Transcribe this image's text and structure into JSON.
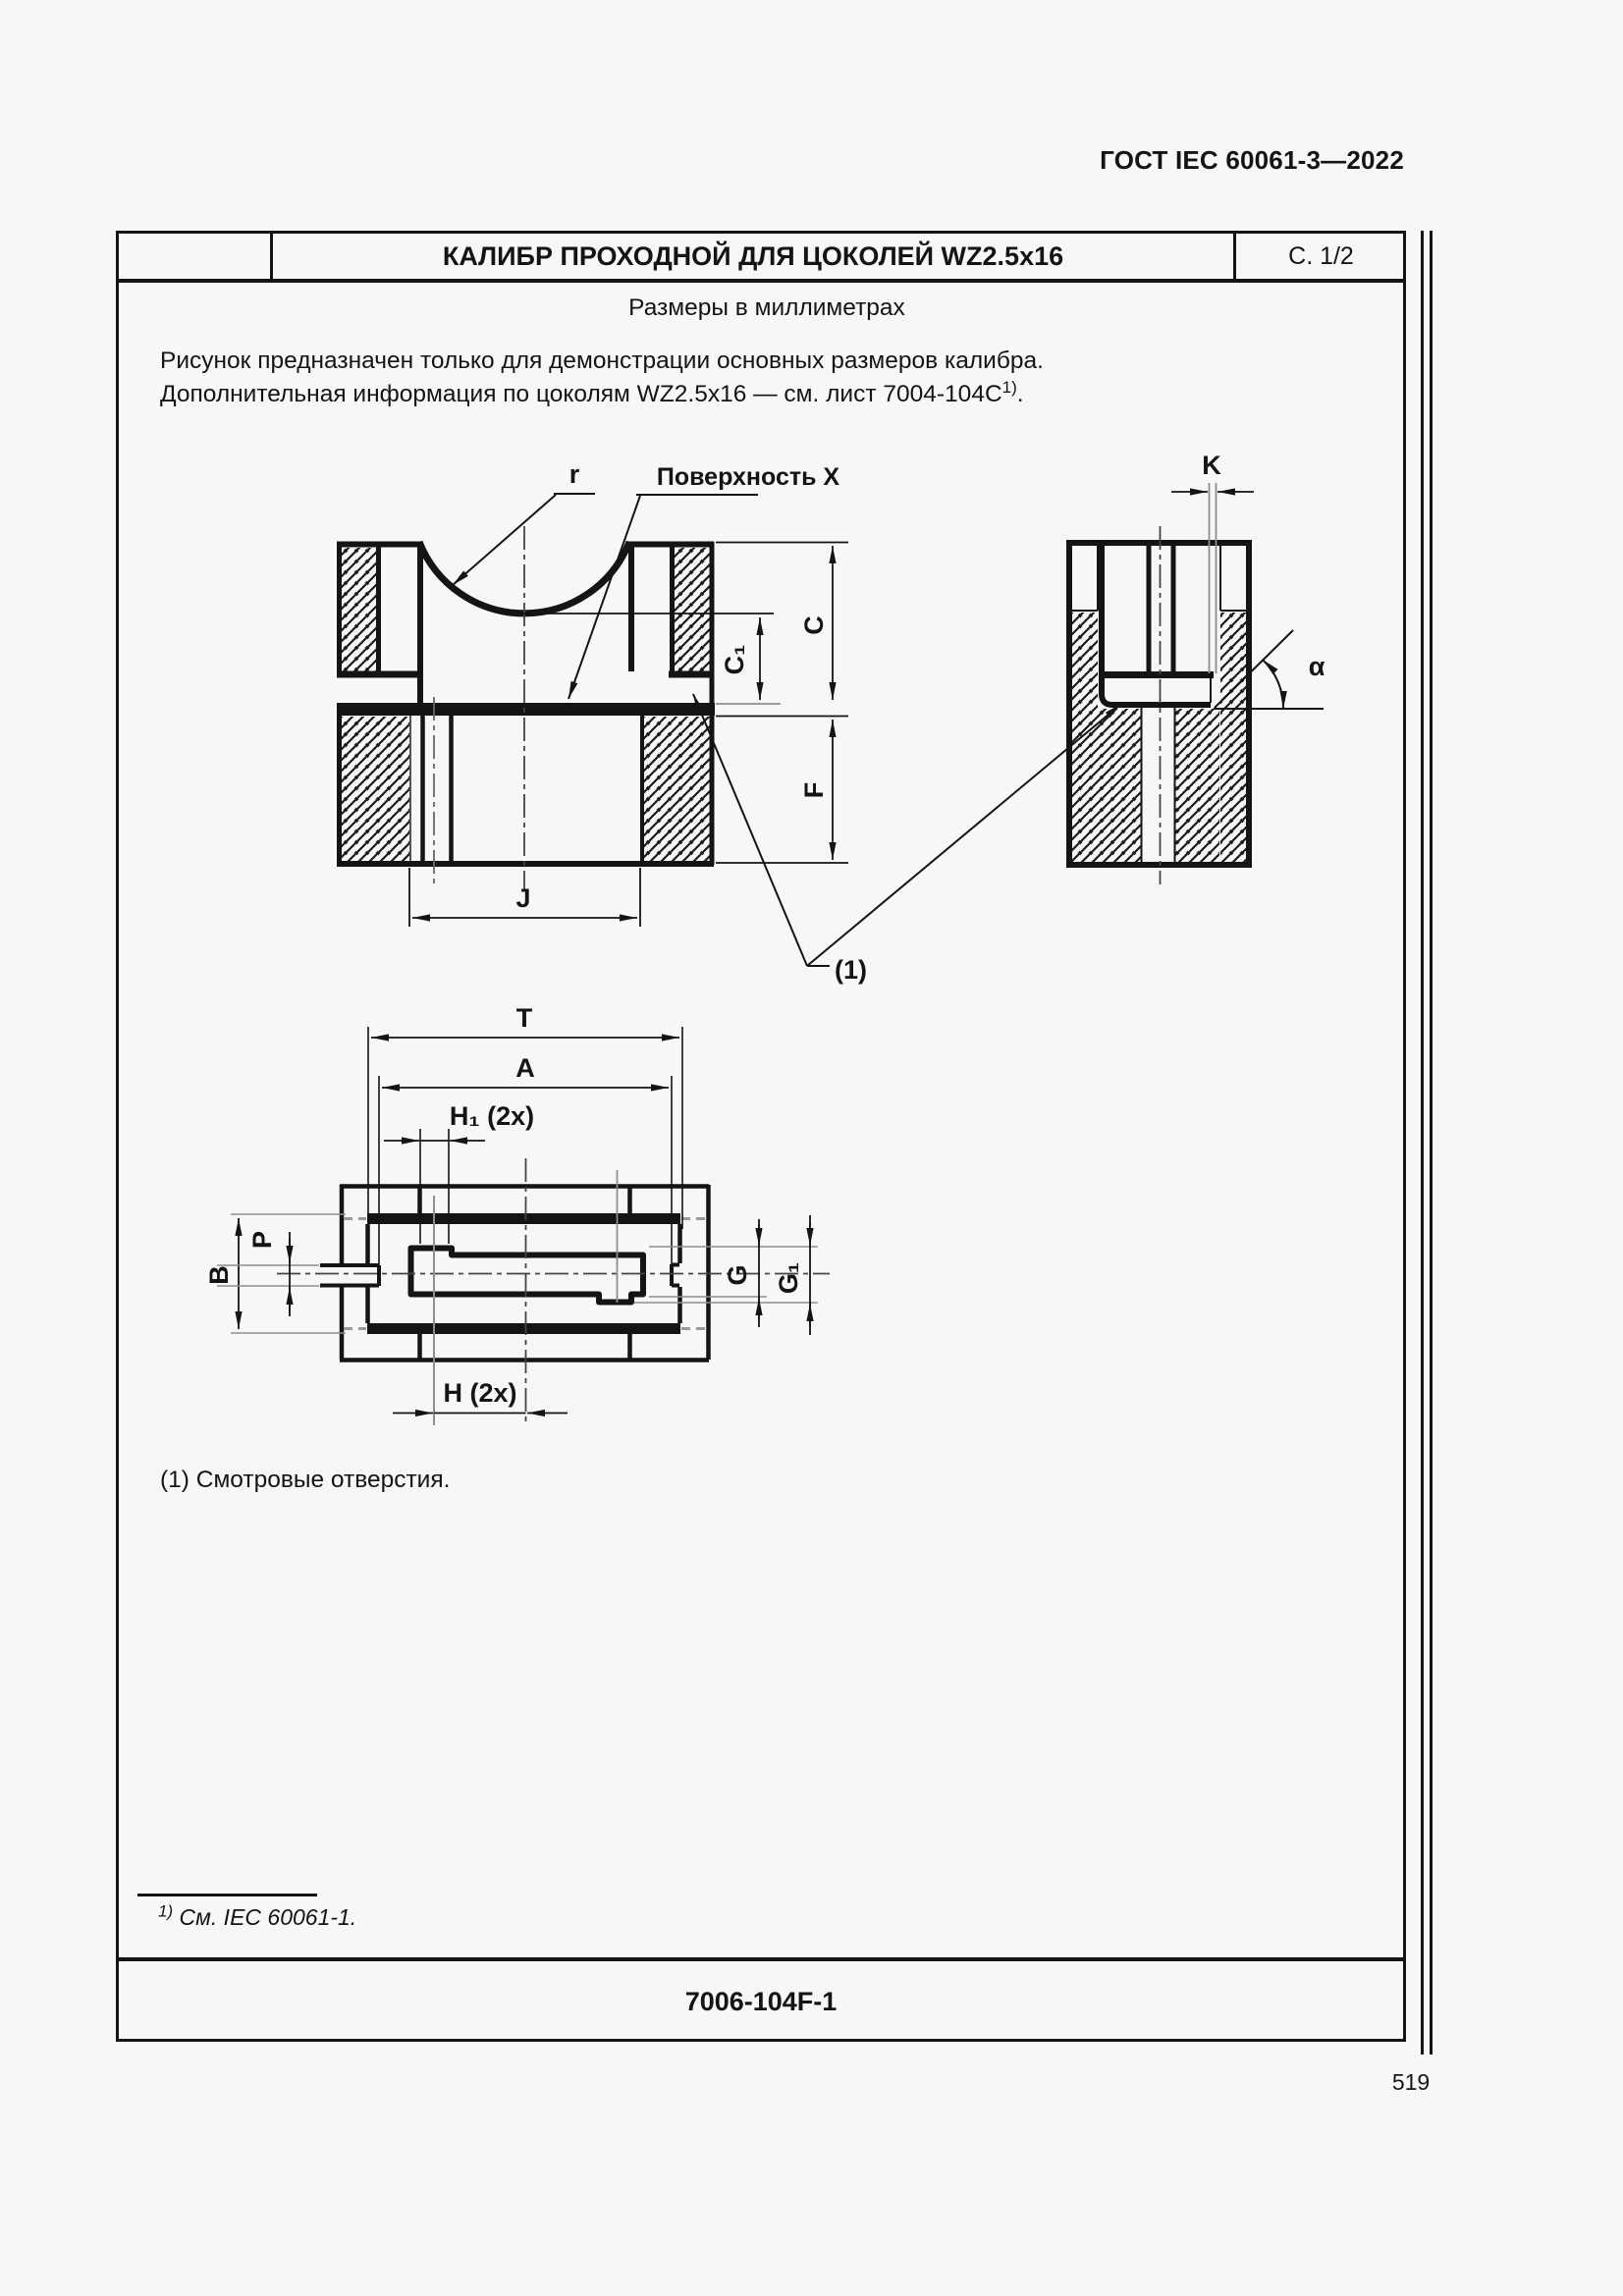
{
  "page": {
    "header": "ГОСТ IEC 60061-3—2022",
    "page_number": "519"
  },
  "sheet": {
    "title": "КАЛИБР ПРОХОДНОЙ ДЛЯ ЦОКОЛЕЙ WZ2.5x16",
    "page_marker": "С. 1/2",
    "units_note": "Размеры в миллиметрах",
    "intro_line1": "Рисунок предназначен только для демонстрации основных размеров калибра.",
    "intro_line2_pre": "Дополнительная информация по цоколям WZ2.5x16 — см. лист 7004-104C",
    "intro_line2_sup": "1)",
    "intro_line2_post": ".",
    "note1": "(1) Смотровые отверстия.",
    "footnote_sup": "1)",
    "footnote_text": " См. IEC 60061-1.",
    "doc_number": "7006-104F-1"
  },
  "drawing": {
    "labels": {
      "r": "r",
      "surface_x": "Поверхность X",
      "k": "K",
      "alpha": "α",
      "c": "C",
      "c1": "C₁",
      "f": "F",
      "j": "J",
      "callout": "(1)",
      "t": "T",
      "a": "A",
      "h1": "H₁ (2x)",
      "p": "P",
      "b": "B",
      "g": "G",
      "g1": "G₁",
      "h": "H (2x)"
    }
  },
  "colors": {
    "ink": "#141414",
    "gray": "#8e8e8e",
    "paper": "#f7f7f6"
  }
}
